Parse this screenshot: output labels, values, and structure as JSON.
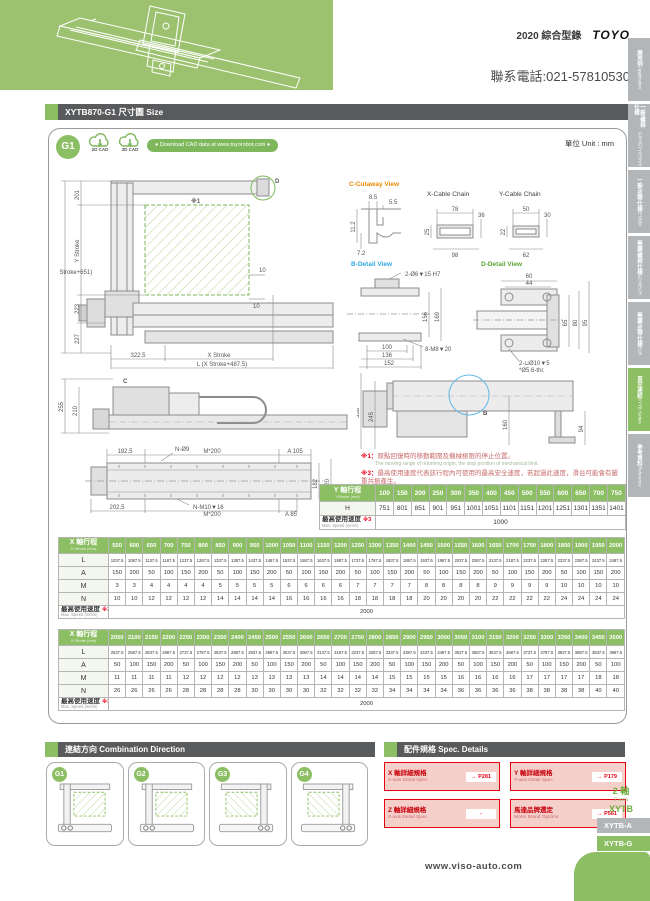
{
  "page": {
    "catalog": "2020 綜合型錄",
    "brand": "TOYO",
    "phone": "聯系電話:021-57810530",
    "unit": "單位 Unit : mm",
    "website": "www.viso-auto.com"
  },
  "colors": {
    "green": "#8CBF63",
    "hero_green": "#9CC26F",
    "dark_bar": "#595A5C",
    "red": "#E60012",
    "orange": "#EB8C00",
    "blue": "#2EA7E0",
    "tab_gray": "#B3B6B9"
  },
  "sidebar": {
    "tabs": [
      {
        "zh": "應用例",
        "en": "Application",
        "active": false
      },
      {
        "zh": "一般/螺桿仕樣",
        "en": "GTH/GTY/ETH/Y",
        "active": false
      },
      {
        "zh": "一般/皮帶仕樣",
        "en": "ETB/M",
        "active": false
      },
      {
        "zh": "無塵/螺桿仕樣",
        "en": "GCH/ECH",
        "active": false
      },
      {
        "zh": "無塵/皮帶仕樣",
        "en": "ECB",
        "active": false
      },
      {
        "zh": "直交連結",
        "en": "XYTB Series",
        "active": true
      },
      {
        "zh": "參考資料",
        "en": "Reference",
        "active": false
      }
    ]
  },
  "title_bar": {
    "text": "XYTB870-G1 尺寸圖 Size"
  },
  "cad": {
    "badge": "G1",
    "cad2d": "2D CAD",
    "cad3d": "3D CAD",
    "download": "● Download CAD data at www.toyorobot.com ●"
  },
  "drawing": {
    "front": {
      "d201": "201",
      "ystroke": "Y Stroke",
      "h": "H (Y Stroke+651)",
      "d223": "223",
      "d227": "227",
      "d3225": "322.5",
      "xstroke": "X Stroke",
      "l": "L (X Stroke+487.5)",
      "d10a": "10",
      "d10b": "10",
      "ref1": "※1",
      "label_d": "D"
    },
    "cutaway": {
      "title": "C-Cutaway View",
      "d85": "8.5",
      "d55": "5.5",
      "d112": "11.2",
      "d72": "7.2"
    },
    "xchain": {
      "title": "X-Cable Chain",
      "d78": "78",
      "d36": "36",
      "d25": "25",
      "d98": "98"
    },
    "ychain": {
      "title": "Y-Cable Chain",
      "d50": "50",
      "d30": "30",
      "d22": "22",
      "d62": "62"
    },
    "bdetail": {
      "title": "B-Detail View",
      "hole": "2-Ø6▼15 H7",
      "d156": "156",
      "d169": "169",
      "d100": "100",
      "d136": "136",
      "d152": "152",
      "tap": "8-M8▼20"
    },
    "ddetail": {
      "title": "D-Detail View",
      "d60": "60",
      "d44": "44",
      "d65": "65",
      "d80": "80",
      "d95": "95",
      "hole": "2-⊔Ø10▼5",
      "thr": "*Ø5.6-thr."
    },
    "side": {
      "d255": "255",
      "d210": "210",
      "label_c": "C"
    },
    "plan": {
      "d1825": "182.5",
      "m200a": "M*200",
      "a105": "A 105",
      "nhole": "N-Ø9",
      "d182": "182",
      "d220": "220",
      "d2025": "202.5",
      "ntap": "N-M10▼16",
      "m200b": "M*200",
      "a85": "A 85"
    },
    "sideview2": {
      "d358": "358",
      "d245": "245",
      "d160": "160",
      "d94": "94",
      "label_b": "B"
    }
  },
  "notes": [
    {
      "mark": "※1：",
      "zh": "原點回復時的移動範圍及機械極限的停止位置。",
      "en": "The moving range of returning origin, the stop position of mechanical limit."
    },
    {
      "mark": "※3：",
      "zh": "最高使用速度代表該行程內可使用的最高安全速度，若超過此速度，滑台可能會有嚴重共振產生。",
      "en": "Maximum speed is refers to the highest safe speed that can be used in stroke, if more than the standard speed, it may occur serious resonance."
    }
  ],
  "y_table": {
    "label_zh": "Y 軸行程",
    "label_en": "YStroke (mm)",
    "strokes": [
      100,
      150,
      200,
      250,
      300,
      350,
      400,
      450,
      500,
      550,
      600,
      650,
      700,
      750
    ],
    "h_label": "H",
    "h_values": [
      751,
      801,
      851,
      901,
      951,
      1001,
      1051,
      1101,
      1151,
      1201,
      1251,
      1301,
      1351,
      1401
    ],
    "speed_zh": "最高使用速度",
    "speed_mark": "※3",
    "speed_en": "Max. Speed (mm/s)",
    "speed_value": "1000"
  },
  "x_table_1": {
    "label_zh": "X 軸行程",
    "label_en": "X Stroke (mm)",
    "strokes": [
      550,
      600,
      650,
      700,
      750,
      800,
      850,
      900,
      950,
      1000,
      1050,
      1100,
      1150,
      1200,
      1250,
      1300,
      1350,
      1400,
      1450,
      1500,
      1550,
      1600,
      1650,
      1700,
      1750,
      1800,
      1850,
      1900,
      1950,
      2000
    ],
    "rows": [
      {
        "label": "L",
        "cls": "lrow",
        "values": [
          "1037.5",
          "1087.5",
          "1137.5",
          "1187.5",
          "1237.5",
          "1287.5",
          "1337.5",
          "1387.5",
          "1437.5",
          "1487.5",
          "1537.5",
          "1587.5",
          "1637.5",
          "1687.5",
          "1737.5",
          "1787.5",
          "1837.5",
          "1887.5",
          "1937.5",
          "1987.5",
          "2037.5",
          "2087.5",
          "2137.5",
          "2187.5",
          "2237.5",
          "2287.5",
          "2337.5",
          "2387.5",
          "2437.5",
          "2487.5"
        ]
      },
      {
        "label": "A",
        "cls": "",
        "values": [
          150,
          200,
          50,
          100,
          150,
          200,
          50,
          100,
          150,
          200,
          50,
          100,
          150,
          200,
          50,
          100,
          150,
          200,
          50,
          100,
          150,
          200,
          50,
          100,
          150,
          200,
          50,
          100,
          150,
          200
        ]
      },
      {
        "label": "M",
        "cls": "",
        "values": [
          3,
          3,
          4,
          4,
          4,
          4,
          5,
          5,
          5,
          5,
          6,
          6,
          6,
          6,
          7,
          7,
          7,
          7,
          8,
          8,
          8,
          8,
          9,
          9,
          9,
          9,
          10,
          10,
          10,
          10
        ]
      },
      {
        "label": "N",
        "cls": "",
        "values": [
          10,
          10,
          12,
          12,
          12,
          12,
          14,
          14,
          14,
          14,
          16,
          16,
          16,
          16,
          18,
          18,
          18,
          18,
          20,
          20,
          20,
          20,
          22,
          22,
          22,
          22,
          24,
          24,
          24,
          24
        ]
      }
    ],
    "speed_zh": "最高使用速度",
    "speed_mark": "※3",
    "speed_en": "Max. Speed (mm/s)",
    "speed_value": "2000"
  },
  "x_table_2": {
    "label_zh": "X 軸行程",
    "label_en": "X Stroke (mm)",
    "strokes": [
      2050,
      2100,
      2150,
      2200,
      2250,
      2300,
      2350,
      2400,
      2450,
      2500,
      2550,
      2600,
      2650,
      2700,
      2750,
      2800,
      2850,
      2900,
      2950,
      3000,
      3050,
      3100,
      3150,
      3200,
      3250,
      3300,
      3350,
      3400,
      3450,
      3500
    ],
    "rows": [
      {
        "label": "L",
        "cls": "lrow",
        "values": [
          "2537.5",
          "2587.5",
          "2637.5",
          "2687.5",
          "2737.5",
          "2787.5",
          "2837.5",
          "2887.5",
          "2937.5",
          "2987.5",
          "3037.5",
          "3087.5",
          "3137.5",
          "3187.5",
          "3237.5",
          "3287.5",
          "3337.5",
          "3387.5",
          "3437.5",
          "3487.5",
          "3537.5",
          "3587.5",
          "3637.5",
          "3687.5",
          "3737.5",
          "3787.5",
          "3837.5",
          "3887.5",
          "3937.5",
          "3987.5"
        ]
      },
      {
        "label": "A",
        "cls": "",
        "values": [
          50,
          100,
          150,
          200,
          50,
          100,
          150,
          200,
          50,
          100,
          150,
          200,
          50,
          100,
          150,
          200,
          50,
          100,
          150,
          200,
          50,
          100,
          150,
          200,
          50,
          100,
          150,
          200,
          50,
          100
        ]
      },
      {
        "label": "M",
        "cls": "",
        "values": [
          11,
          11,
          11,
          11,
          12,
          12,
          12,
          12,
          13,
          13,
          13,
          13,
          14,
          14,
          14,
          14,
          15,
          15,
          15,
          15,
          16,
          16,
          16,
          16,
          17,
          17,
          17,
          17,
          18,
          18
        ]
      },
      {
        "label": "N",
        "cls": "",
        "values": [
          26,
          26,
          26,
          26,
          28,
          28,
          28,
          28,
          30,
          30,
          30,
          30,
          32,
          32,
          32,
          32,
          34,
          34,
          34,
          34,
          36,
          36,
          36,
          36,
          38,
          38,
          38,
          38,
          40,
          40
        ]
      }
    ],
    "speed_zh": "最高使用速度",
    "speed_mark": "※3",
    "speed_en": "Max. Speed (mm/s)",
    "speed_value": "2000"
  },
  "combination": {
    "title": "連結方向 Combination Direction",
    "items": [
      {
        "badge": "G1",
        "mirror": false
      },
      {
        "badge": "G2",
        "mirror": false
      },
      {
        "badge": "G3",
        "mirror": true
      },
      {
        "badge": "G4",
        "mirror": true
      }
    ]
  },
  "spec_details": {
    "title": "配件規格 Spec. Details",
    "items": [
      {
        "zh": "X 軸詳細規格",
        "en": "X-axis Detail Spec.",
        "ref": "→ P281"
      },
      {
        "zh": "Y 軸詳細規格",
        "en": "Y-axis Detail Spec.",
        "ref": "→ P179"
      },
      {
        "zh": "Z 軸詳細規格",
        "en": "Z-axis Detail Spec.",
        "ref": "-"
      },
      {
        "zh": "馬達品牌選定",
        "en": "Motor Brand Options",
        "ref": "→ P561"
      }
    ]
  },
  "series_label": {
    "zh": "2 軸",
    "en": "2 axis",
    "name": "XYTB"
  },
  "bottom_tabs": [
    {
      "label": "XYTB-A",
      "active": false
    },
    {
      "label": "XYTB-G",
      "active": true
    }
  ]
}
